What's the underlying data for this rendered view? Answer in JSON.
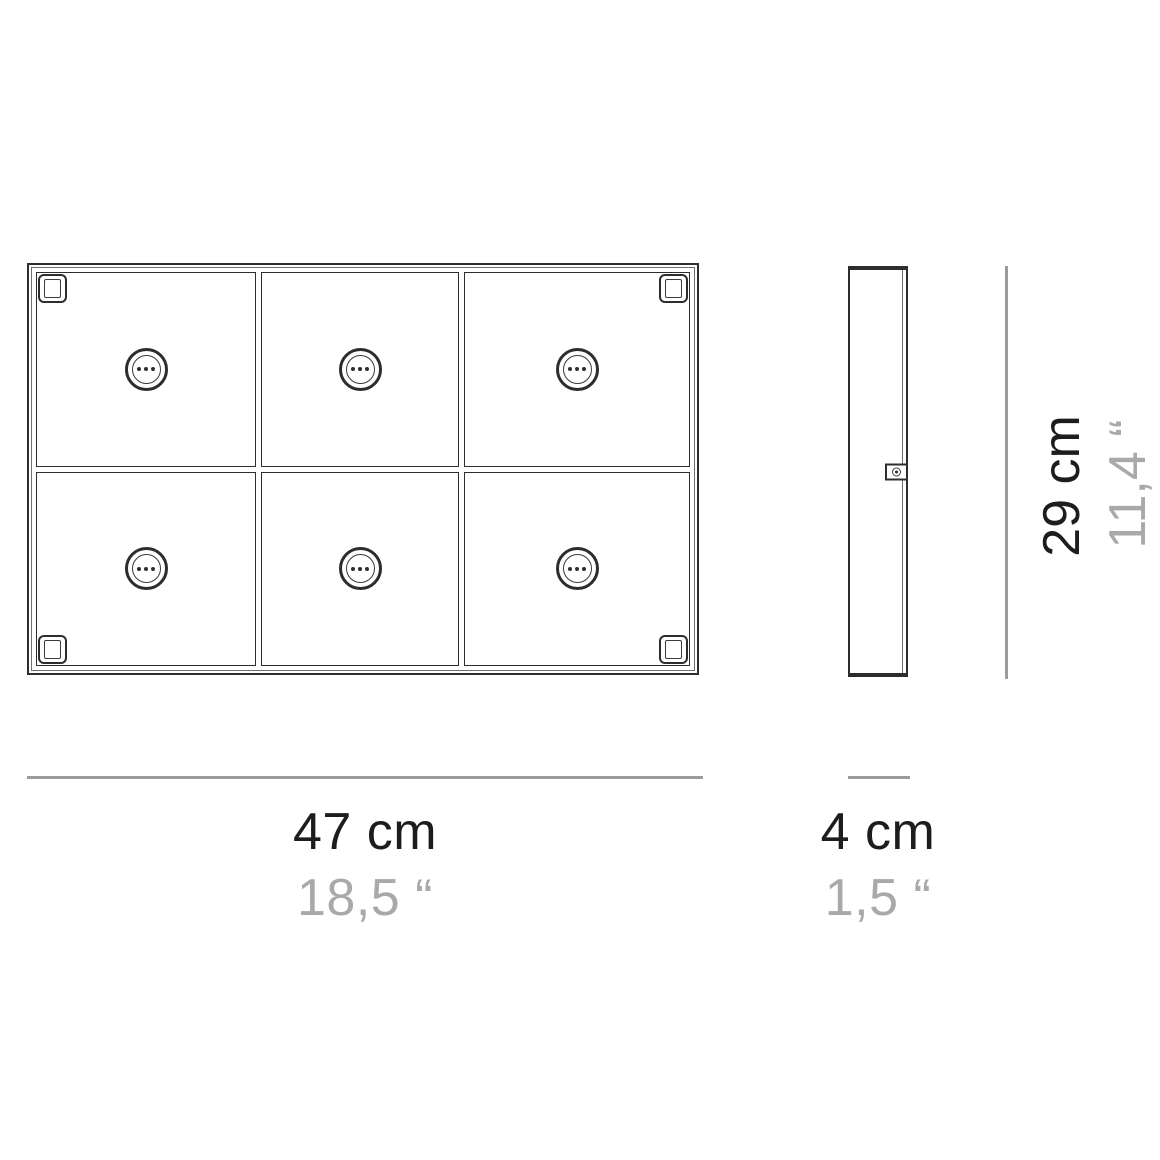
{
  "diagram": {
    "title": "product-dimension-drawing",
    "colors": {
      "background": "#ffffff",
      "line": "#2d2d2d",
      "line_mid": "#3c3c3c",
      "line_light": "#6e6e6e",
      "dim_line": "#9c9c9c",
      "text_primary": "#1d1d1d",
      "text_secondary": "#a9a9a9"
    },
    "front_view": {
      "name": "front-view",
      "grid_columns": 3,
      "grid_rows": 2,
      "module_count": 6,
      "socket_pins_per_module": 3,
      "corner_brackets": 4,
      "width_label_cm": "47 cm",
      "width_label_in": "18,5 “"
    },
    "side_view": {
      "name": "side-view",
      "depth_label_cm": "4 cm",
      "depth_label_in": "1,5 “"
    },
    "height_label_cm": "29 cm",
    "height_label_in": "11,4 “"
  }
}
